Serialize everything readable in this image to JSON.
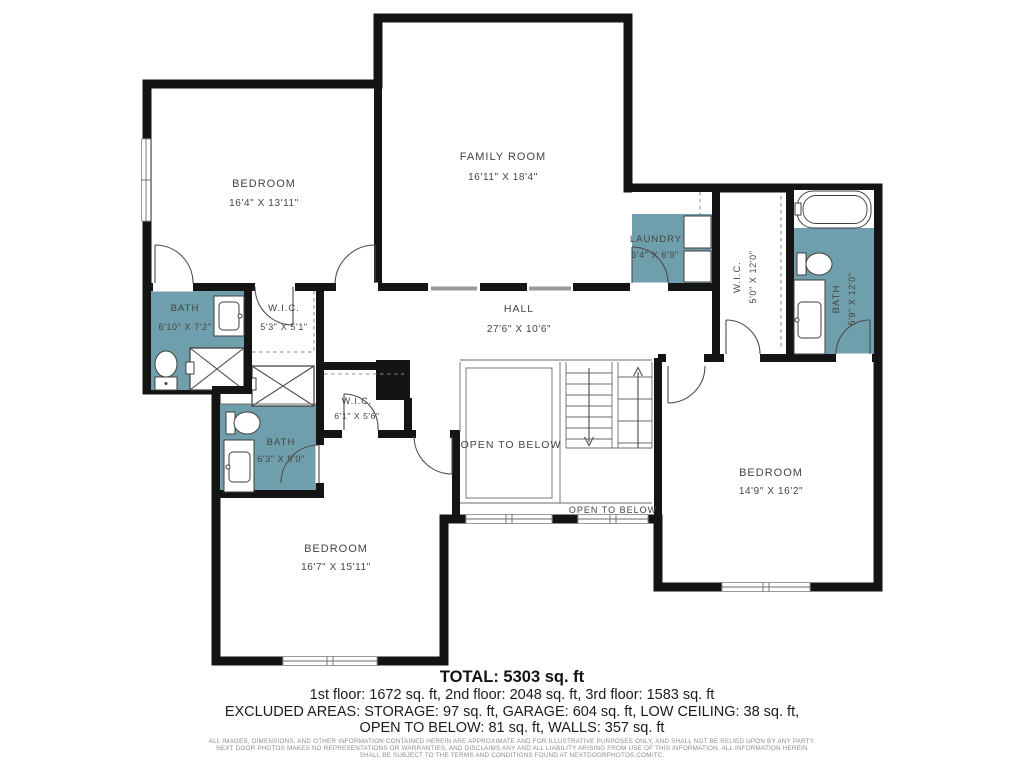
{
  "plan": {
    "rooms": {
      "bedroom_tl": {
        "name": "BEDROOM",
        "dims": "16'4\" X 13'11\""
      },
      "family_room": {
        "name": "FAMILY ROOM",
        "dims": "16'11\" X 18'4\""
      },
      "laundry": {
        "name": "LAUNDRY",
        "dims": "6'4\" X 6'9\""
      },
      "wic_right": {
        "name": "W.I.C.",
        "dims": "5'0\" X 12'0\""
      },
      "bath_right": {
        "name": "BATH",
        "dims": "5'9\" X 12'0\""
      },
      "hall": {
        "name": "HALL",
        "dims": "27'6\" X 10'6\""
      },
      "bath_left": {
        "name": "BATH",
        "dims": "6'10\" X 7'2\""
      },
      "wic_left": {
        "name": "W.I.C.",
        "dims": "5'3\" X 5'1\""
      },
      "wic_mid": {
        "name": "W.I.C.",
        "dims": "6'1\" X 5'6\""
      },
      "bath_mid": {
        "name": "BATH",
        "dims": "6'3\" X 9'0\""
      },
      "bedroom_right": {
        "name": "BEDROOM",
        "dims": "14'9\" X 16'2\""
      },
      "bedroom_bottom": {
        "name": "BEDROOM",
        "dims": "16'7\" X 15'11\""
      },
      "open_below": {
        "name": "OPEN TO BELOW"
      },
      "open_below_small": {
        "name": "OPEN TO BELOW"
      }
    },
    "colors": {
      "wall": "#141414",
      "floor": "#e9e6db",
      "wet_room": "#6f9eac",
      "label_text": "#45453e"
    }
  },
  "summary": {
    "total": "TOTAL: 5303 sq. ft",
    "floors": "1st floor: 1672 sq. ft, 2nd floor: 2048 sq. ft, 3rd floor: 1583 sq. ft",
    "excluded_1": "EXCLUDED AREAS: STORAGE: 97 sq. ft, GARAGE: 604 sq. ft, LOW CEILING: 38 sq. ft,",
    "excluded_2": "OPEN TO BELOW: 81 sq. ft, WALLS: 357 sq. ft"
  },
  "disclaimer": {
    "lines": [
      "ALL IMAGES, DIMENSIONS, AND OTHER INFORMATION CONTAINED HEREIN ARE APPROXIMATE AND FOR ILLUSTRATIVE PURPOSES ONLY, AND SHALL NOT BE RELIED UPON BY ANY PARTY.",
      "NEXT DOOR PHOTOS MAKES NO REPRESENTATIONS OR WARRANTIES, AND DISCLAIMS ANY AND ALL LIABILITY ARISING FROM USE OF THIS INFORMATION. ALL INFORMATION HEREIN",
      "SHALL BE SUBJECT TO THE TERMS AND CONDITIONS FOUND AT NEXTDOORPHOTOS.COM/TC."
    ]
  }
}
